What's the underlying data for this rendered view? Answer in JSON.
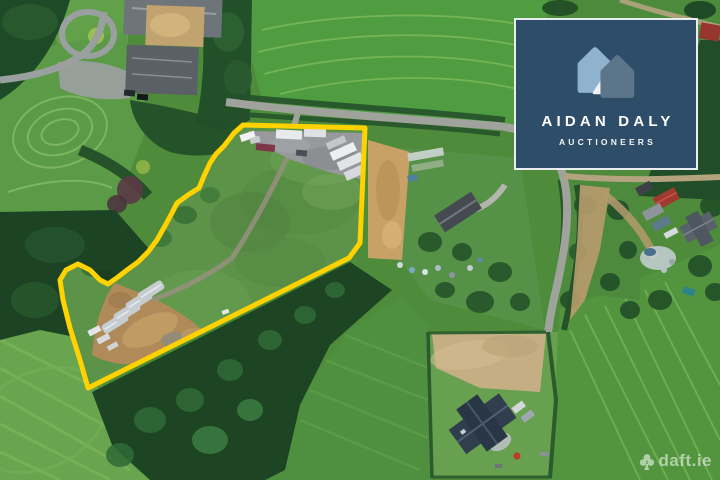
{
  "badge": {
    "title": "AIDAN DALY",
    "subtitle": "AUCTIONEERS",
    "bg_color": "#2E4D68",
    "border_color": "rgba(255,255,255,0.9)",
    "text_color": "#FFFFFF",
    "house_light_color": "#8FB3CE",
    "house_dark_color": "#5D7589",
    "house_fold_color": "#EDF2F5"
  },
  "watermark": {
    "label": "daft.ie",
    "color": "rgba(255,255,255,0.55)"
  },
  "boundary": {
    "color": "#FFD200",
    "stroke_width": 5,
    "points": "243,125 365,128 360,243 349,258 88,388 80,360 70,328 63,300 60,280 66,270 78,264 90,270 100,280 108,284 118,277 127,270 138,262 148,252 157,240 166,224 173,211 177,203 188,195 199,188 204,176 210,163 216,154 224,146 234,133"
  }
}
